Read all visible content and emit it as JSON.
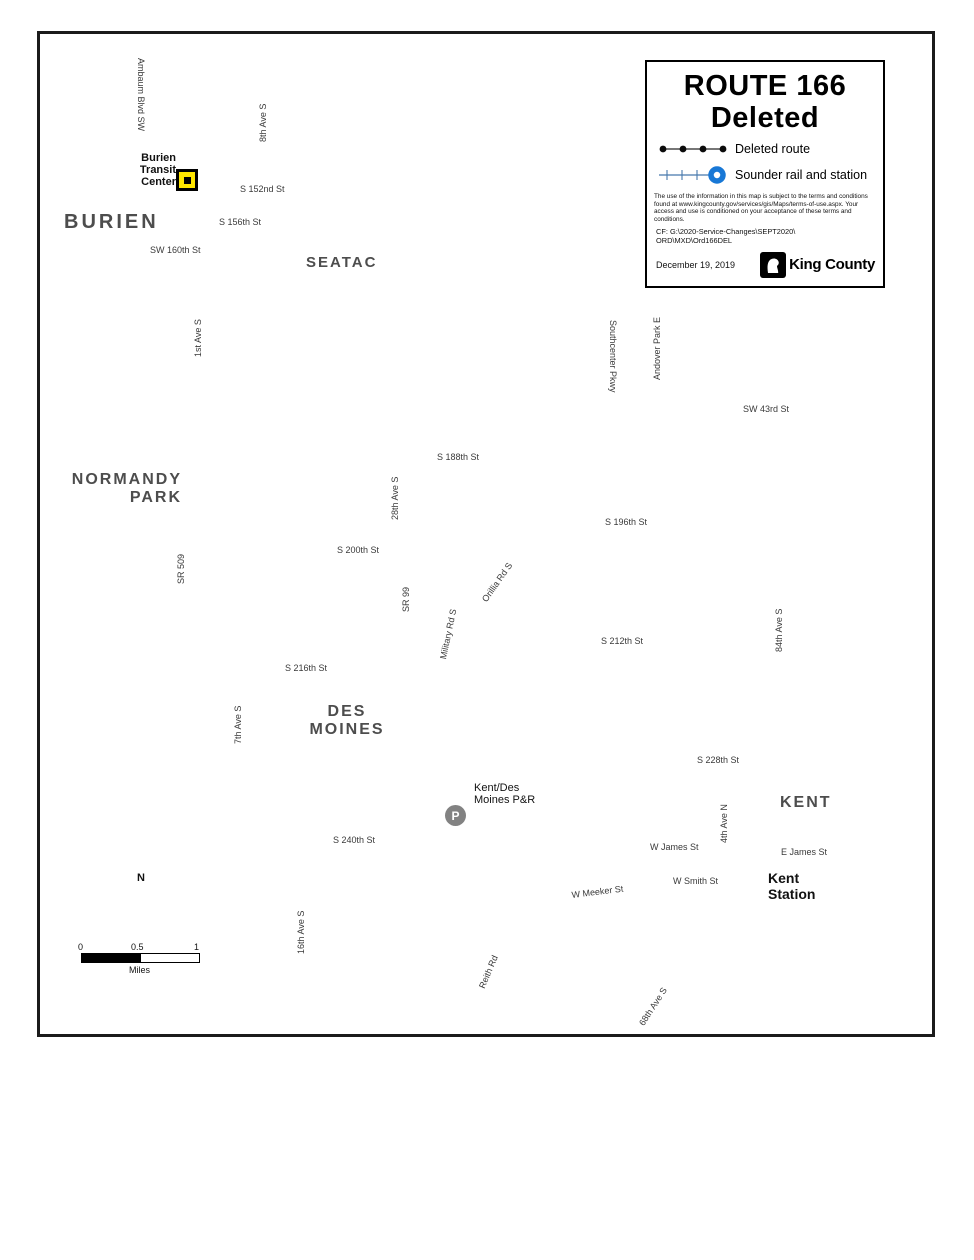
{
  "title_box": {
    "line1": "ROUTE 166",
    "line2": "Deleted",
    "legend": [
      {
        "label": "Deleted route"
      },
      {
        "label": "Sounder rail and station"
      }
    ],
    "disclaimer": "The use of the information in this map is subject to the terms and conditions found at www.kingcounty.gov/services/gis/Maps/terms-of-use.aspx. Your access and use is conditioned on your acceptance of these terms and conditions.",
    "file_ref_line1": "CF:  G:\\2020-Service-Changes\\SEPT2020\\",
    "file_ref_line2": "ORD\\MXD\\Ord166DEL",
    "date": "December 19, 2019",
    "logo_text": "King County"
  },
  "cities": {
    "burien": "BURIEN",
    "seatac": "SEATAC",
    "normandy_1": "NORMANDY",
    "normandy_2": "PARK",
    "desmoines_1": "DES",
    "desmoines_2": "MOINES",
    "kent": "KENT"
  },
  "streets": {
    "ambaum": "Ambaum Blvd SW",
    "ave8": "8th Ave S",
    "s152": "S 152nd St",
    "s156": "S 156th St",
    "sw160": "SW 160th St",
    "ave1": "1st Ave S",
    "sr509": "SR 509",
    "sw43": "SW 43rd St",
    "s188": "S 188th St",
    "ave28": "28th Ave S",
    "s196": "S 196th St",
    "s200": "S 200th St",
    "sr99": "SR 99",
    "military": "Military Rd S",
    "orillia": "Orillia Rd S",
    "southcenter": "Southcenter Pkwy",
    "andover": "Andover Park E",
    "ave84": "84th Ave S",
    "s212": "S 212th St",
    "s216": "S 216th St",
    "ave7": "7th Ave S",
    "s228": "S 228th St",
    "s240": "S 240th St",
    "ave16": "16th Ave S",
    "wjames": "W James St",
    "ejames": "E James St",
    "wsmith": "W Smith St",
    "wmeeker": "W Meeker St",
    "ave4": "4th Ave N",
    "reith": "Reith Rd",
    "ave68": "68th Ave S"
  },
  "markers": {
    "btc_1": "Burien",
    "btc_2": "Transit",
    "btc_3": "Center",
    "pr_symbol": "P",
    "pr_1": "Kent/Des",
    "pr_2": "Moines P&R",
    "kent_station_1": "Kent",
    "kent_station_2": "Station",
    "i5_shield": "5"
  },
  "compass": {
    "north": "N"
  },
  "scale_bar": {
    "t0": "0",
    "t05": "0.5",
    "t1": "1",
    "unit": "Miles"
  },
  "colors": {
    "water": "#9cc7e6",
    "route": "#000000",
    "rail_blue": "#4678ac",
    "station_blue": "#1878d6",
    "road_gray": "#c9c9c9",
    "city_label": "#4d4d4d",
    "pr_gray": "#828282",
    "btc_yellow": "#ffe600",
    "i5_red": "#c32435",
    "i5_blue": "#223a8f"
  }
}
